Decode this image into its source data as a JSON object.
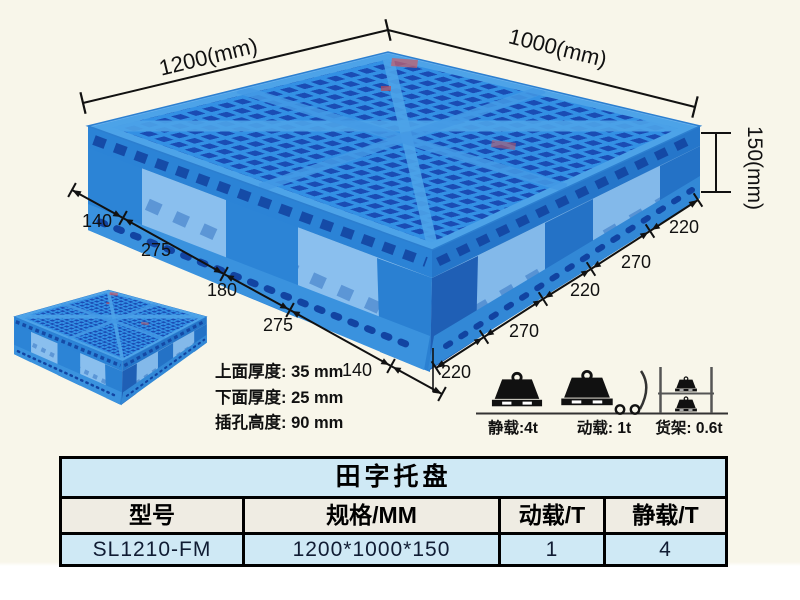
{
  "illustration": {
    "dim_length_label": "1200(mm)",
    "dim_width_label": "1000(mm)",
    "dim_height_label": "150(mm)",
    "left_edge_segments": [
      "140",
      "275",
      "180",
      "275",
      "140"
    ],
    "right_edge_segments": [
      "220",
      "270",
      "220",
      "270",
      "220"
    ],
    "thickness_notes": [
      "上面厚度: 35 mm",
      "下面厚度: 25 mm",
      "插孔高度: 90 mm"
    ],
    "load_ratings": {
      "static": "静载:4t",
      "dynamic": "动载: 1t",
      "rack": "货架: 0.6t"
    },
    "colors": {
      "pallet_blue": "#2f8de0",
      "pallet_dark_blue": "#1a4cb4",
      "pallet_light_blue": "#8abfee",
      "dimension_ink": "#111111"
    }
  },
  "spec_table": {
    "title": "田字托盘",
    "columns": [
      "型号",
      "规格/MM",
      "动载/T",
      "静载/T"
    ],
    "rows": [
      [
        "SL1210-FM",
        "1200*1000*150",
        "1",
        "4"
      ]
    ],
    "title_bg": "#cfe9f5",
    "header_bg": "#efece3",
    "row_bg": "#cfe9f5"
  }
}
